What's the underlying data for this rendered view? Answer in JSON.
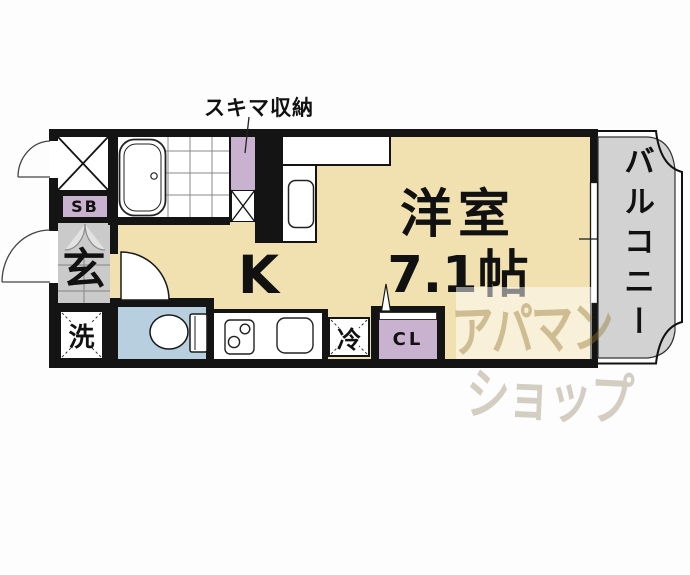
{
  "floorplan": {
    "callout": {
      "storage_label": "スキマ収納"
    },
    "rooms": {
      "western_room_name": "洋室",
      "western_room_size": "7.1帖",
      "kitchen_label": "K",
      "balcony_label": "バルコニー",
      "entrance_label": "玄",
      "shoe_box_label": "SB",
      "washer_label": "洗",
      "refrigerator_label": "冷",
      "closet_label": "CL"
    },
    "watermark": {
      "line1": "アパマン",
      "line2": "ショップ"
    },
    "colors": {
      "wall": "#141414",
      "room_floor_tan": "#f1e1b1",
      "storage_lavender": "#c9b2cf",
      "toilet_blue": "#b8cfdf",
      "entrance_gray": "#cacaca",
      "balcony_gray": "#d2d2d2"
    }
  }
}
